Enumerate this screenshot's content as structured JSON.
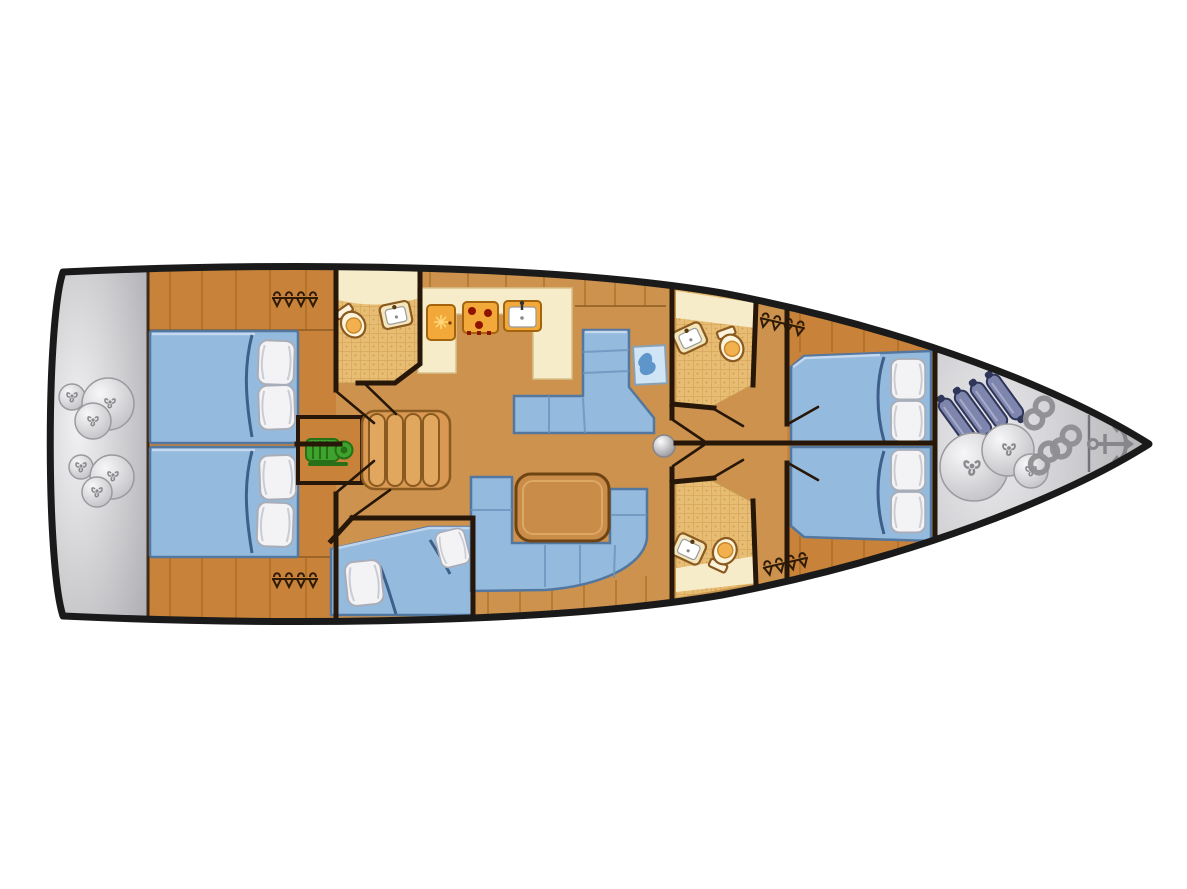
{
  "meta": {
    "type": "boat-floor-plan",
    "subject": "sailing yacht interior layout, top-down view",
    "visible_text": []
  },
  "colors": {
    "background": "#ffffff",
    "hull_outline": "#1a1a1a",
    "wall_dark": "#271708",
    "wood_cabin": "#c8823a",
    "wood_floor": "#cc924e",
    "wood_plank_line": "#9c6218",
    "wood_steps": "#e2a75f",
    "counter_cream": "#f6ecca",
    "tile_base": "#e7bd74",
    "tile_line": "#cf9b4e",
    "upholstery_blue": "#94bade",
    "upholstery_border": "#54779f",
    "pillow_white": "#f3f3f5",
    "table_wood": "#c98c49",
    "appliance_orange": "#f3a93a",
    "burner_red": "#8e1300",
    "engine_green": "#3da32c",
    "deck_gray_light": "#f1f1f3",
    "deck_gray_dark": "#b0b0b4",
    "bow_gray_light": "#ebebee",
    "bow_gray_dark": "#a9a9ad",
    "fender_blue_gray": "#7e86ad",
    "fender_cap_dark": "#30355a",
    "ball_light": "#f7f7f8",
    "ball_dark": "#c0c0c5",
    "rope_gray": "#8f8f93",
    "anchor_gray": "#87878b",
    "map_paper": "#cfe4f4",
    "map_land": "#5e96cc"
  },
  "rooms": [
    "stern-swim-platform",
    "aft-cabin-top",
    "aft-cabin-bottom",
    "aft-head",
    "bunk-cabin",
    "galley",
    "salon",
    "navigation-corner",
    "corridor",
    "forward-head-top",
    "forward-head-bottom",
    "forward-cabin-top",
    "forward-cabin-bottom",
    "bow-sail-locker",
    "anchor-locker"
  ],
  "objects": [
    "double-bed",
    "pillow",
    "blanket-fold",
    "l-shaped-settee",
    "u-shaped-settee",
    "salon-table",
    "chart-map",
    "fridge",
    "stove",
    "galley-sink",
    "engine",
    "companionway-steps",
    "toilet",
    "washbasin",
    "hanging-locker",
    "deck-hatch",
    "fender-ball",
    "bow-fender",
    "rope-coil",
    "anchor"
  ],
  "inventory": {
    "double_beds_aft": 2,
    "double_beds_forward": 2,
    "bunk_berths": 1,
    "pillows": 10,
    "settees": 2,
    "salon_tables": 1,
    "chart_tables": 1,
    "heads_bathrooms": 3,
    "toilets": 3,
    "bathroom_sinks": 3,
    "galley_fridge": 1,
    "galley_stove_burners": 3,
    "galley_sinks": 1,
    "engines": 1,
    "companionway_step_count": 5,
    "hanging_lockers": 4,
    "deck_hatches": 1,
    "stern_fender_balls": 6,
    "bow_fenders": 4,
    "bow_sail_bags": 3,
    "rope_coils": 3,
    "anchors": 1
  }
}
